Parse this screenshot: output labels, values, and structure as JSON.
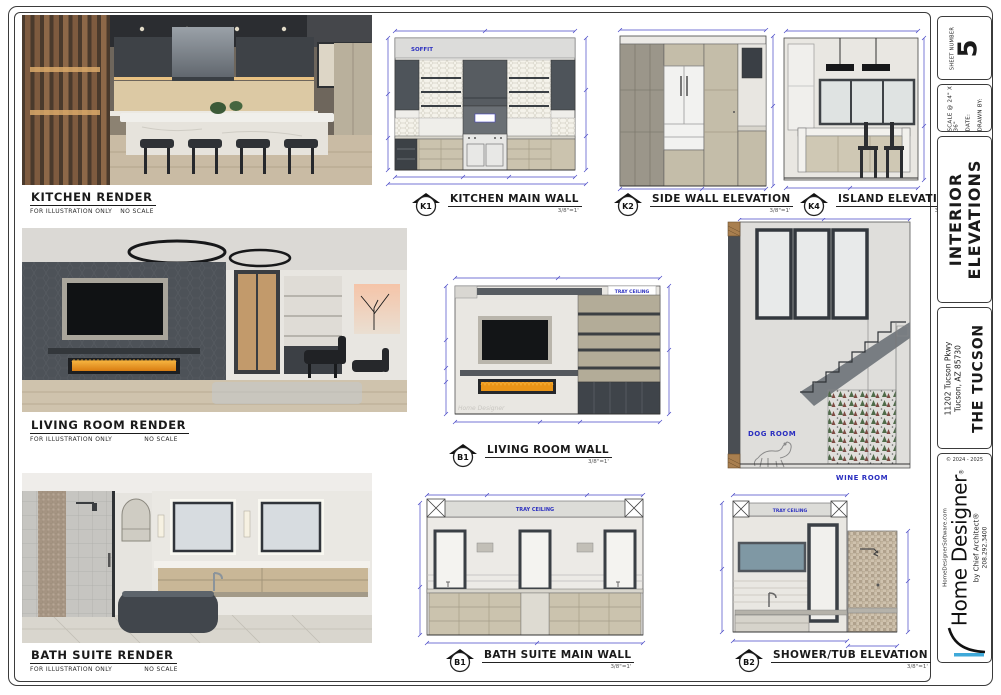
{
  "annotations": {
    "soffit": "SOFFIT",
    "tray_ceiling": "TRAY CEILING",
    "dog_room": "DOG ROOM",
    "wine_room": "WINE ROOM",
    "watermark": "Home Designer",
    "illustration_note": "FOR ILLUSTRATION ONLY",
    "no_scale_note": "NO SCALE"
  },
  "renders": {
    "kitchen": {
      "title": "KITCHEN RENDER"
    },
    "living": {
      "title": "LIVING ROOM RENDER"
    },
    "bath": {
      "title": "BATH SUITE RENDER"
    }
  },
  "elevations": {
    "k1": {
      "id": "K1",
      "title": "KITCHEN MAIN WALL",
      "scale": "3/8\"=1'"
    },
    "k2": {
      "id": "K2",
      "title": "SIDE WALL ELEVATION",
      "scale": "3/8\"=1'"
    },
    "k4": {
      "id": "K4",
      "title": "ISLAND ELEVATION",
      "scale": "3/8\"=1'"
    },
    "living_room": {
      "id": "B1",
      "title": "LIVING ROOM WALL",
      "scale": "3/8\"=1'"
    },
    "bath_main": {
      "id": "B1",
      "title": "BATH SUITE MAIN WALL",
      "scale": "3/8\"=1'"
    },
    "shower_tub": {
      "id": "B2",
      "title": "SHOWER/TUB ELEVATION",
      "scale": "3/8\"=1'"
    }
  },
  "title_block": {
    "sheet_number_label": "SHEET NUMBER",
    "sheet_number": "5",
    "scale_label": "SCALE @ 24\" X 36\"",
    "date_label": "DATE:",
    "drawn_by_label": "DRAWN BY:",
    "sheet_title_line1": "INTERIOR",
    "sheet_title_line2": "ELEVATIONS",
    "address_line1": "11202 Tucson Pkwy",
    "address_line2": "Tucson, AZ 85730",
    "plan_name": "THE TUCSON",
    "copyright": "© 2024 - 2025",
    "brand_name": "Home Designer",
    "brand_reg": "®",
    "brand_tagline": "by Chief Architect®",
    "brand_phone": "208.292.3400",
    "brand_website": "HomeDesignerSoftware.com"
  },
  "colors": {
    "dimension_blue": "#4747c6",
    "annotation_blue": "#2b2fc0",
    "logo_accent_blue": "#3fa9d9",
    "flame_orange": "#e8920f"
  }
}
